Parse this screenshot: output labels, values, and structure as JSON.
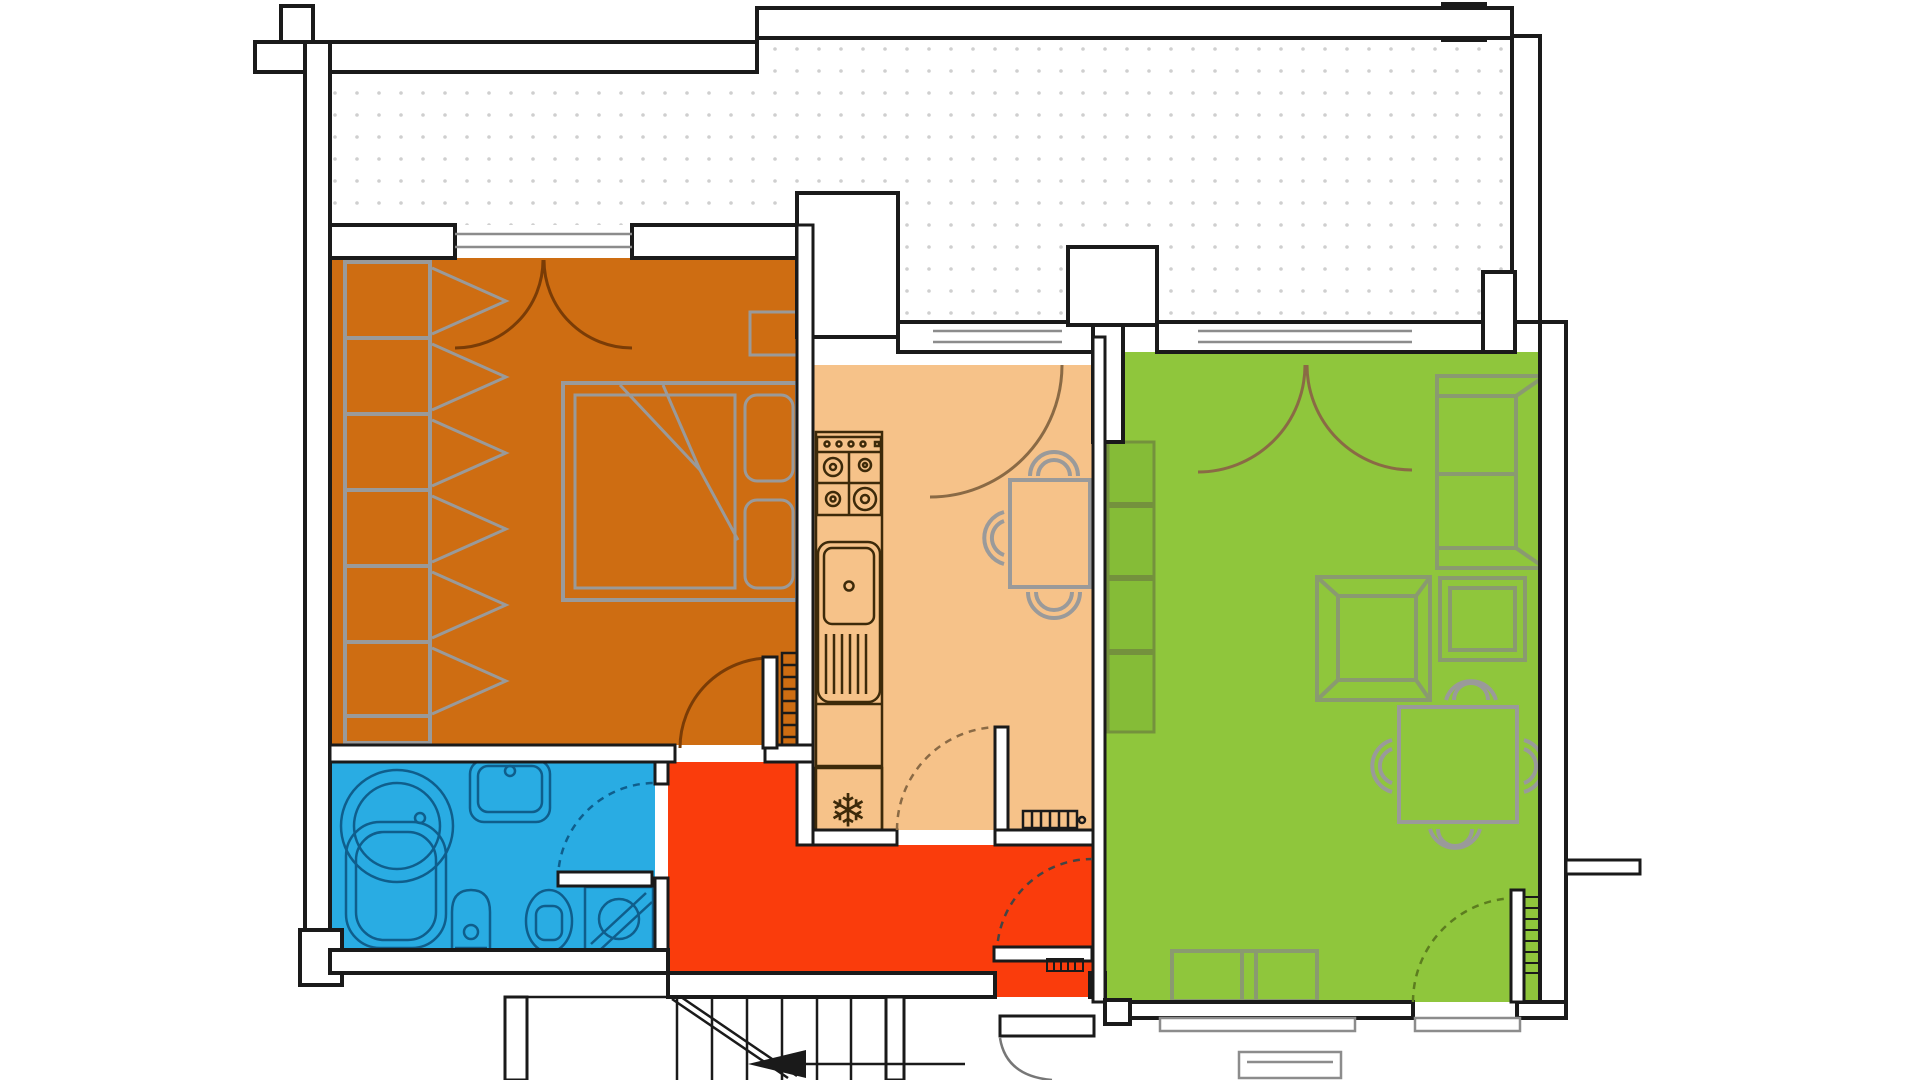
{
  "title": "apartment-floor-plan",
  "walls": {
    "stroke": "#1a1a1a",
    "fill": "#ffffff"
  },
  "terrace": {
    "name": "terrace",
    "dot_color": "#cfcfcf",
    "fill": "#ffffff"
  },
  "rooms": {
    "bedroom": {
      "name": "bedroom",
      "color": "#CE6D12",
      "arc_color": "#7a3c06",
      "fixtures": [
        "wardrobe",
        "double-bed",
        "pillows",
        "nightstand",
        "radiator",
        "french-balcony-doors",
        "door-to-hallway"
      ]
    },
    "kitchen": {
      "name": "kitchen",
      "color": "#F6C289",
      "arc_color": "#8a6a45",
      "fixtures": [
        "gas-stove",
        "sink-with-drainer",
        "counter-cabinet",
        "fridge-freezer",
        "dining-table",
        "chairs",
        "balcony-door",
        "door-to-hallway",
        "radiator-grille"
      ]
    },
    "living_room": {
      "name": "living-room",
      "color": "#8FC63C",
      "shelf_color": "#85BC37",
      "arc_color": "#5c7d1f",
      "fixtures": [
        "bookshelf",
        "sofa",
        "coffee-table",
        "stool",
        "dining-table",
        "chairs",
        "tv-lowboard",
        "radiator",
        "french-balcony-doors",
        "exterior-door"
      ]
    },
    "bathroom": {
      "name": "bathroom",
      "color": "#29ACE3",
      "fixture_color": "#0f5e8c",
      "fixtures": [
        "corner-bathtub",
        "washbasin",
        "bidet",
        "toilet",
        "washing-machine",
        "door-to-hallway"
      ]
    },
    "hallway": {
      "name": "hallway",
      "color": "#FA3C0C",
      "fixtures": [
        "front-door",
        "threshold"
      ]
    },
    "stairwell": {
      "name": "stairwell",
      "fixtures": [
        "stairs",
        "direction-arrow",
        "building-entrance-door"
      ]
    }
  },
  "icons": {
    "snowflake": "❄"
  },
  "windows": {
    "glass_color": "#8c8c8c"
  }
}
